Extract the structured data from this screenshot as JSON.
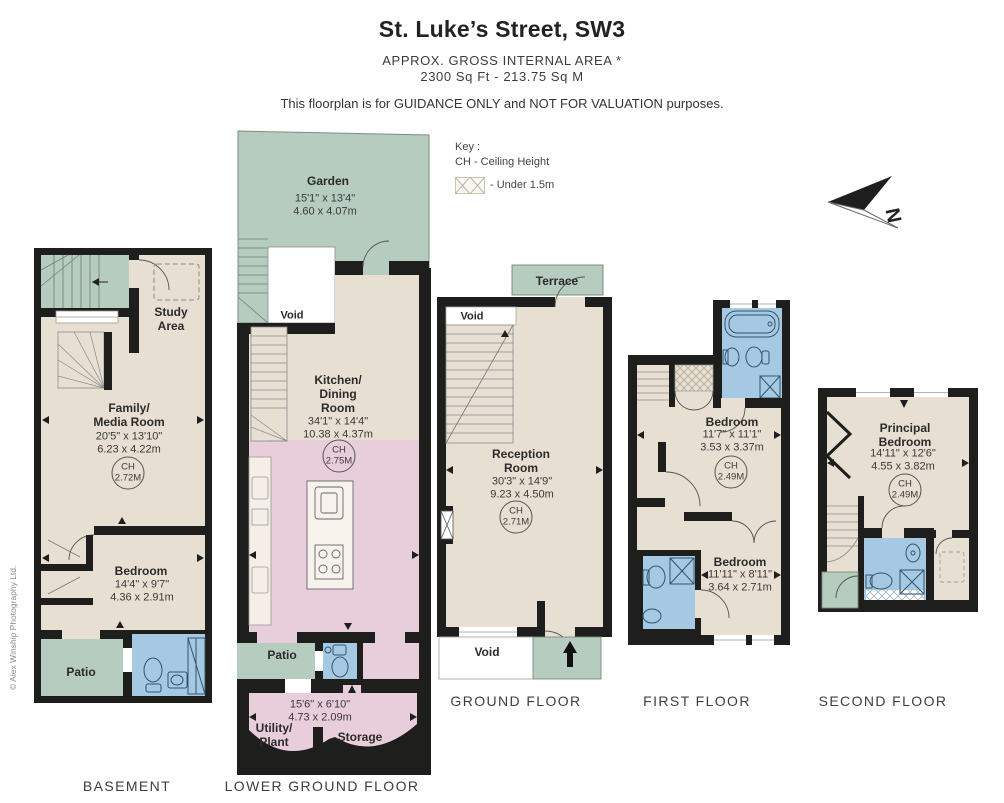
{
  "header": {
    "title": "St. Luke’s Street, SW3",
    "subtitle_line1": "APPROX. GROSS INTERNAL  AREA *",
    "subtitle_line2": "2300 Sq Ft  -  213.75 Sq M",
    "disclaimer": "This floorplan is for GUIDANCE ONLY and NOT FOR VALUATION purposes."
  },
  "key": {
    "title": "Key :",
    "ch_note": "CH - Ceiling Height",
    "under_note": "- Under 1.5m"
  },
  "compass": {
    "label": "N"
  },
  "watermark": "© Alex Winship Photography Ltd.",
  "colors": {
    "wall": "#1e1e1c",
    "room": "#e7dfd2",
    "outdoor": "#b5ccbe",
    "kitchen": "#e8cdda",
    "bathroom": "#a5c9e2"
  },
  "floors": {
    "basement": {
      "label": "BASEMENT",
      "study": {
        "name": "Study\nArea"
      },
      "family": {
        "name": "Family/\nMedia Room",
        "dim_ft": "20'5\" x 13'10\"",
        "dim_m": "6.23 x 4.22m",
        "ch_label": "CH",
        "ch_value": "2.72M"
      },
      "bedroom": {
        "name": "Bedroom",
        "dim_ft": "14'4\" x 9'7\"",
        "dim_m": "4.36 x 2.91m"
      },
      "patio": {
        "name": "Patio"
      }
    },
    "lower_ground": {
      "label": "LOWER GROUND FLOOR",
      "garden": {
        "name": "Garden",
        "dim_ft": "15'1\" x 13'4\"",
        "dim_m": "4.60 x 4.07m"
      },
      "void_upper": {
        "name": "Void"
      },
      "kitchen": {
        "name": "Kitchen/\nDining\nRoom",
        "dim_ft": "34'1\" x 14'4\"",
        "dim_m": "10.38 x 4.37m",
        "ch_label": "CH",
        "ch_value": "2.75M"
      },
      "patio": {
        "name": "Patio"
      },
      "utility": {
        "name": "Utility/\nPlant"
      },
      "storage": {
        "name": "Storage"
      },
      "utility_storage_dims": {
        "dim_ft": "15'6\" x 6'10\"",
        "dim_m": "4.73 x 2.09m"
      }
    },
    "ground": {
      "label": "GROUND FLOOR",
      "terrace": {
        "name": "Terrace"
      },
      "void_upper": {
        "name": "Void"
      },
      "reception": {
        "name": "Reception\nRoom",
        "dim_ft": "30'3\" x 14'9\"",
        "dim_m": "9.23 x 4.50m",
        "ch_label": "CH",
        "ch_value": "2.71M"
      },
      "void_lower": {
        "name": "Void"
      }
    },
    "first": {
      "label": "FIRST FLOOR",
      "bedroom_front": {
        "name": "Bedroom",
        "dim_ft": "11'7\" x 11'1\"",
        "dim_m": "3.53 x 3.37m",
        "ch_label": "CH",
        "ch_value": "2.49M"
      },
      "bedroom_back": {
        "name": "Bedroom",
        "dim_ft": "11'11\" x 8'11\"",
        "dim_m": "3.64 x 2.71m"
      }
    },
    "second": {
      "label": "SECOND FLOOR",
      "principal": {
        "name": "Principal\nBedroom",
        "dim_ft": "14'11\" x 12'6\"",
        "dim_m": "4.55 x 3.82m",
        "ch_label": "CH",
        "ch_value": "2.49M"
      }
    }
  }
}
